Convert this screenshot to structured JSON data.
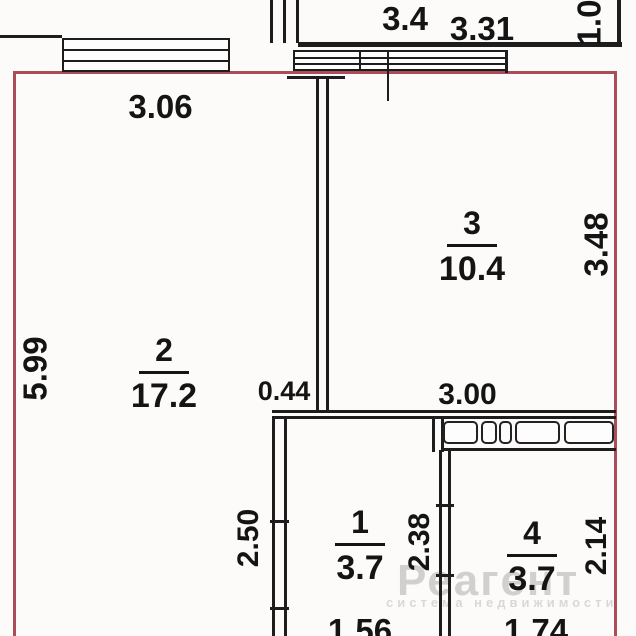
{
  "plan": {
    "type": "apartment-floor-plan",
    "colors": {
      "outline": "#a94d58",
      "lines": "#1d1d1d",
      "watermark_gray": "#c9c5c5"
    }
  },
  "rooms": [
    {
      "number": "2",
      "area": "17.2"
    },
    {
      "number": "3",
      "area": "10.4"
    },
    {
      "number": "1",
      "area": "3.7"
    },
    {
      "number": "4",
      "area": "3.7"
    }
  ],
  "dimensions": {
    "upper_room_width_a": "3.4",
    "upper_room_width_b": "3.31",
    "upper_right_vertical": "1.0",
    "room2_top_width": "3.06",
    "room2_left_height": "5.99",
    "room3_right_height": "3.48",
    "room3_bottom_width": "3.00",
    "wall_stub": "0.44",
    "room1_left_height": "2.50",
    "room1_right_height": "2.38",
    "room4_right_height": "2.14",
    "room1_bottom_width": "1.56",
    "room4_bottom_width": "1.74"
  },
  "watermark": {
    "title": "Реагент",
    "subtitle": "система недвижимости"
  }
}
